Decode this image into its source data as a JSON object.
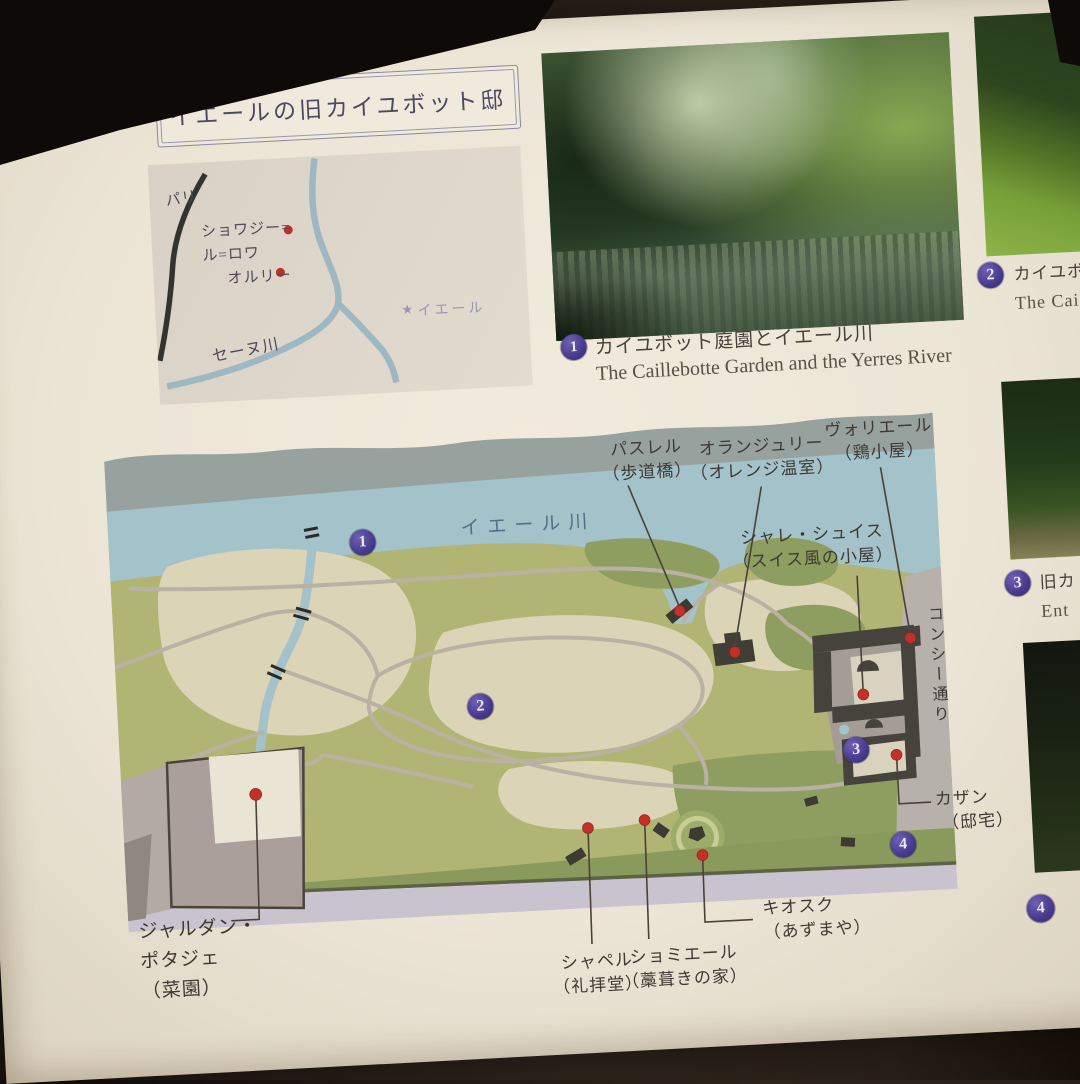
{
  "title": "イエールの旧カイユボット邸",
  "inset_map": {
    "paris": "パリ",
    "choisy_line1": "ショワジー=",
    "choisy_line2": "ル=ロワ",
    "orly": "オルリー",
    "seine": "セーヌ川",
    "yerres_star": "★",
    "yerres": "イエール"
  },
  "caption1": {
    "number": "1",
    "jp": "カイユボット庭園とイエール川",
    "en": "The Caillebotte Garden and the Yerres River"
  },
  "sidebar": {
    "item2": {
      "number": "2",
      "jp": "カイユボ",
      "en": "The Cai"
    },
    "item3": {
      "number": "3",
      "jp": "旧カ",
      "en": "Ent"
    },
    "item4": {
      "number": "4"
    }
  },
  "map": {
    "river": "イエール川",
    "street": "コンシー通り",
    "marker1": "1",
    "marker2": "2",
    "marker3": "3",
    "marker4": "4",
    "passerelle": {
      "l1": "パスレル",
      "l2": "（歩道橋）"
    },
    "orangerie": {
      "l1": "オランジュリー",
      "l2": "（オレンジ温室）"
    },
    "voliere": {
      "l1": "ヴォリエール",
      "l2": "（鶏小屋）"
    },
    "chalet": {
      "l1": "シャレ・シュイス",
      "l2": "（スイス風の小屋）"
    },
    "casin": {
      "l1": "カザン",
      "l2": "（邸宅）"
    },
    "potager": {
      "l1": "ジャルダン・",
      "l2": "ポタジェ",
      "l3": "（菜園）"
    },
    "chapelle": {
      "l1": "シャペル",
      "l2": "（礼拝堂）"
    },
    "chaumiere": {
      "l1": "ショミエール",
      "l2": "（藁葺きの家）"
    },
    "kiosque": {
      "l1": "キオスク",
      "l2": "（あずまや）"
    }
  },
  "colors": {
    "accent_purple": "#4a3c8e",
    "marker_red": "#c23128",
    "river_blue": "#a3c2ca",
    "terrain_green": "#b1b573"
  }
}
